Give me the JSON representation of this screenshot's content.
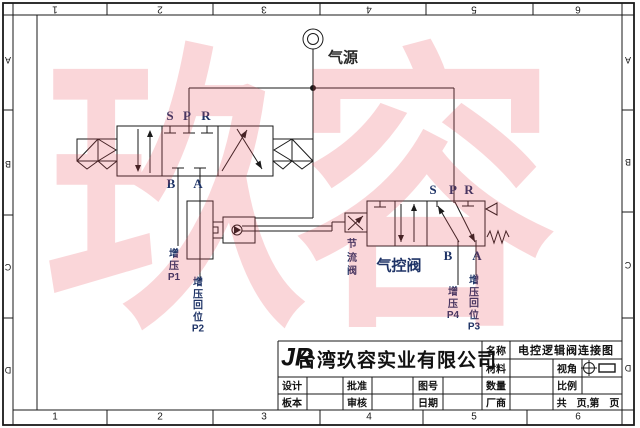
{
  "watermark_text": "玖容",
  "grid": {
    "cols": [
      "1",
      "2",
      "3",
      "4",
      "5",
      "6"
    ],
    "rows": [
      "A",
      "B",
      "C",
      "D"
    ]
  },
  "schematic": {
    "air_source": "气源",
    "left_valve": {
      "s": "S",
      "p": "P",
      "r": "R",
      "b": "B",
      "a": "A",
      "b_label": "增\n压\nP1",
      "a_label": "增\n压\n回\n位\nP2"
    },
    "throttle_label": "节\n流\n阀",
    "right_valve": {
      "s": "S",
      "p": "P",
      "r": "R",
      "b": "B",
      "a": "A",
      "name": "气控阀",
      "b_label": "增\n压\nP4",
      "a_label": "增\n压\n回\n位\nP3"
    }
  },
  "title_block": {
    "logo": "JR",
    "company": "台湾玖容实业有限公司",
    "name_label": "名称",
    "name_value": "电控逻辑阀连接图",
    "material_label": "材料",
    "view_label": "视角",
    "design_label": "设计",
    "approve_label": "批准",
    "drawing_no_label": "图号",
    "qty_label": "数量",
    "scale_label": "比例",
    "version_label": "板本",
    "review_label": "审核",
    "date_label": "日期",
    "vendor_label": "厂商",
    "pages_label": "共　页,第　页"
  },
  "colors": {
    "line": "#1a1a1a",
    "label_navy": "#1e3366",
    "watermark": "rgba(232,70,80,0.22)"
  }
}
